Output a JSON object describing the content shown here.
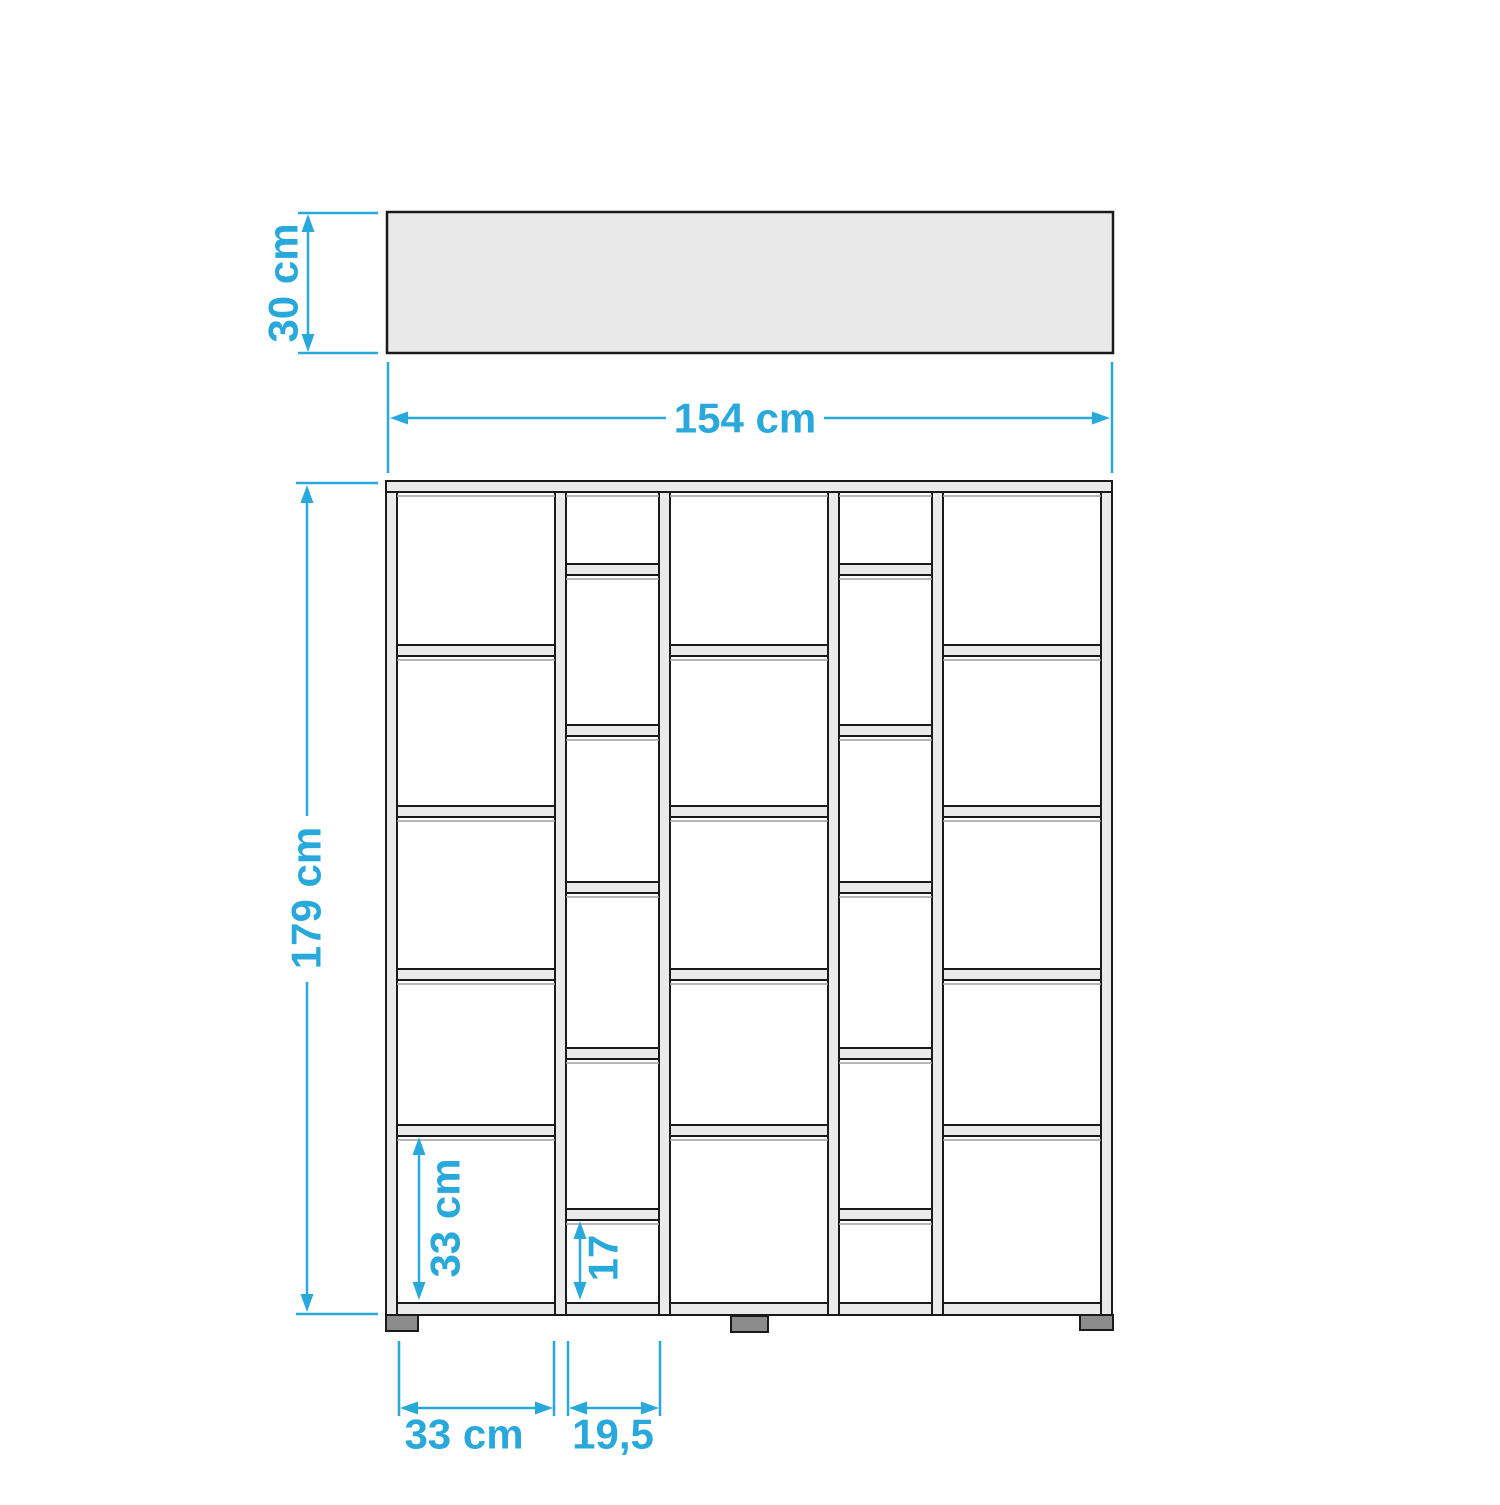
{
  "colors": {
    "accent_blue": "#29A8DC",
    "panel_fill": "#E9E9E9",
    "board_fill": "#EAEAEA",
    "outline": "#1A1A1A",
    "foot_fill": "#8C8C8C",
    "background": "#FFFFFF"
  },
  "top_view": {
    "depth_label": "30 cm",
    "width_label": "154 cm"
  },
  "front_view": {
    "height_label": "179 cm",
    "cell_height_label": "33 cm",
    "small_cell_height_label": "17",
    "wide_column_width_label": "33 cm",
    "narrow_column_width_label": "19,5",
    "column_types": [
      "wide",
      "narrow",
      "wide",
      "narrow",
      "wide"
    ],
    "wide_column_cells": 5,
    "narrow_column_cells": 6,
    "feet_count": 3
  }
}
